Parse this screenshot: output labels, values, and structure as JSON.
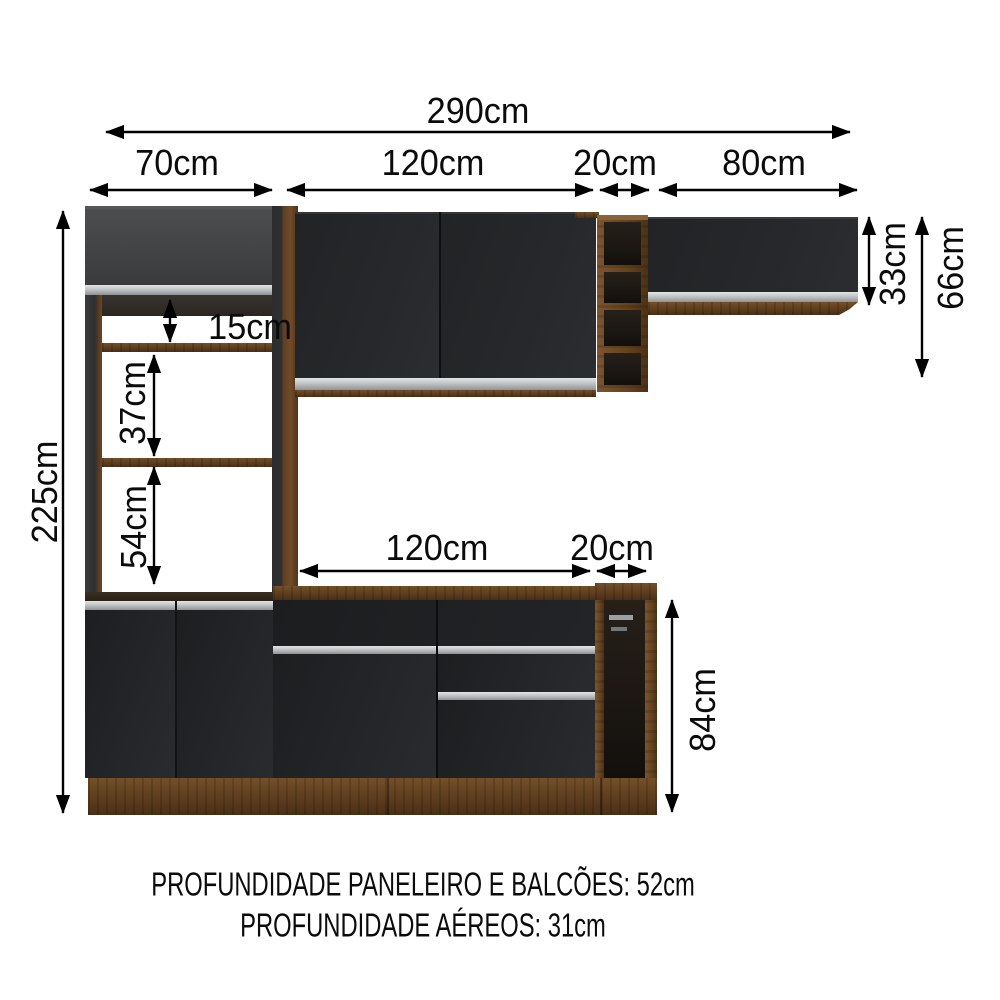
{
  "diagram": {
    "title": "kitchen-cabinet-dimension-diagram",
    "unit": "cm",
    "labels": {
      "total_width": "290cm",
      "tower_width": "70cm",
      "upper_cabinet_width": "120cm",
      "upper_niche_width": "20cm",
      "right_cabinet_width": "80cm",
      "right_cabinet_height": "33cm",
      "upper_total_height": "66cm",
      "total_height": "225cm",
      "shelf_gap_top": "15cm",
      "shelf_gap_middle": "37cm",
      "shelf_gap_bottom": "54cm",
      "counter_width": "120cm",
      "counter_niche_width": "20cm",
      "counter_height": "84cm"
    },
    "footer": {
      "line1": "PROFUNDIDADE PANELEIRO E BALCÕES: 52cm",
      "line2": "PROFUNDIDADE AÉREOS: 31cm"
    },
    "colors": {
      "background": "#ffffff",
      "line": "#000000",
      "door_black": "#232528",
      "door_grey": "#434547",
      "wood": "#5d3d1f",
      "handle_silver": "#c9cccd"
    }
  }
}
